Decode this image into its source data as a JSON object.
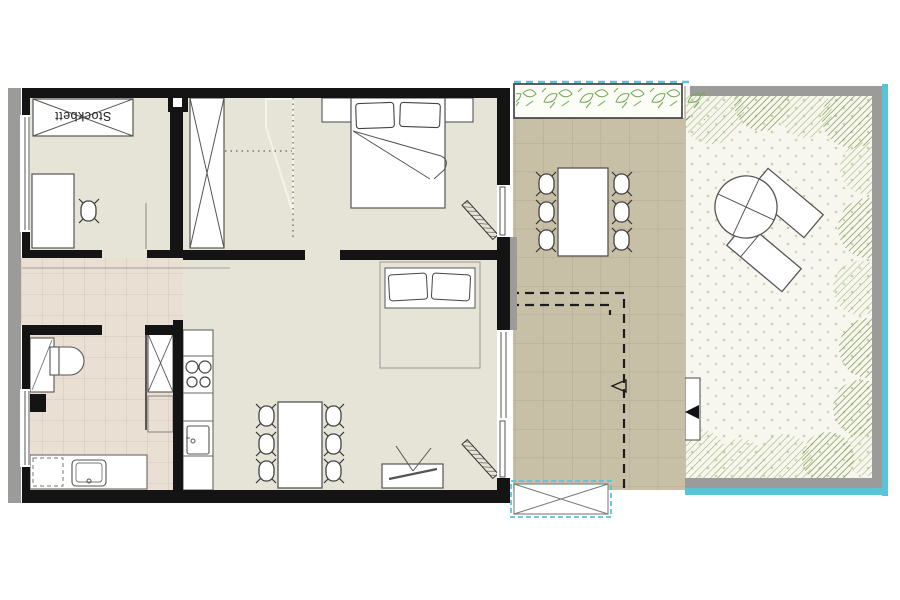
{
  "plan": {
    "labels": {
      "bunk_bed": "Stockbett"
    },
    "colors": {
      "wall": "#141414",
      "floor_interior": "#e6e4d6",
      "tiles_wet": "#eadfd3",
      "tiles_wet_line": "#d6c7b8",
      "terrace_tile": "#c8bfa7",
      "terrace_tile_line": "#b2a98f",
      "garden_bg": "#f8f7ef",
      "garden_dot": "#cfcab0",
      "bush_green": "#9cb878",
      "bush_green_dark": "#7e9c55",
      "plant_green": "#6ea84f",
      "exterior_trim": "#9b9b99",
      "boundary_cyan": "#57c4d8",
      "furniture_stroke": "#555555",
      "furniture_fill": "#ffffff"
    }
  }
}
